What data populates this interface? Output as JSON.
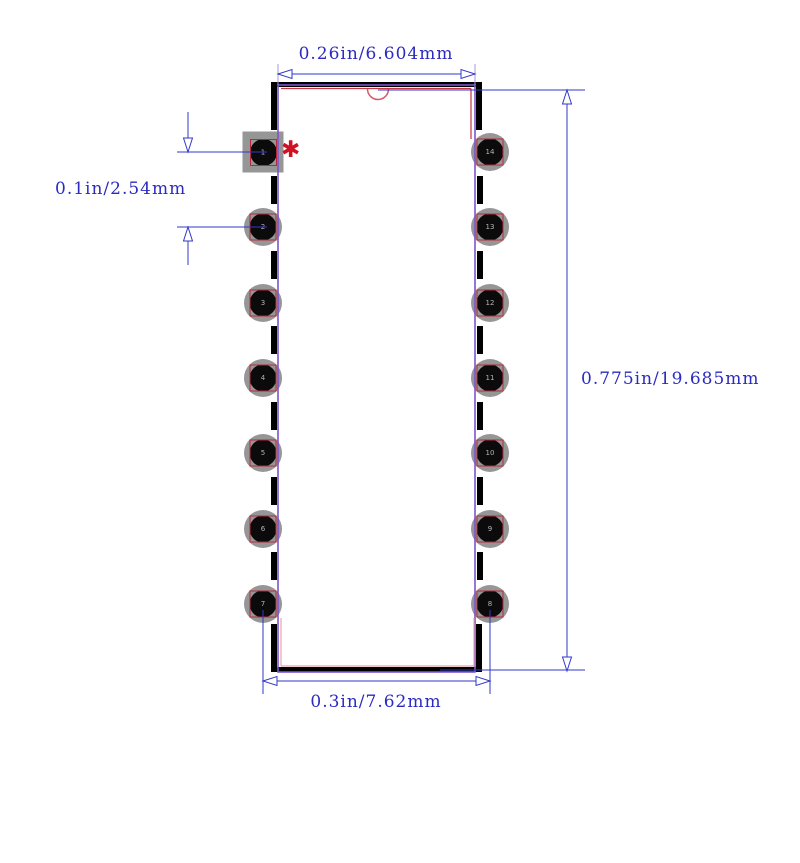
{
  "diagram": {
    "type": "pcb-footprint-dip14",
    "dimensions": {
      "top": {
        "label": "0.26in/6.604mm"
      },
      "left": {
        "label": "0.1in/2.54mm"
      },
      "right": {
        "label": "0.775in/19.685mm"
      },
      "bottom": {
        "label": "0.3in/7.62mm"
      }
    },
    "pads": {
      "left_numbers": [
        "1",
        "2",
        "3",
        "4",
        "5",
        "6",
        "7"
      ],
      "right_numbers": [
        "14",
        "13",
        "12",
        "11",
        "10",
        "9",
        "8"
      ]
    },
    "pin1_marker": "✱"
  },
  "colors": {
    "pad_gray": "#969696",
    "pad_hole": "#0b0b0b",
    "pad_ring_red": "#b5293d",
    "number_gray": "#b5b5b5",
    "dim_blue": "#3038c8",
    "text_blue": "#2b2bc0",
    "lavender": "#a49ae0",
    "purple": "#7a55cc",
    "red": "#c23344",
    "pink": "#e8a3ab",
    "notch_red": "#d6596a",
    "marker_red": "#d11122"
  }
}
